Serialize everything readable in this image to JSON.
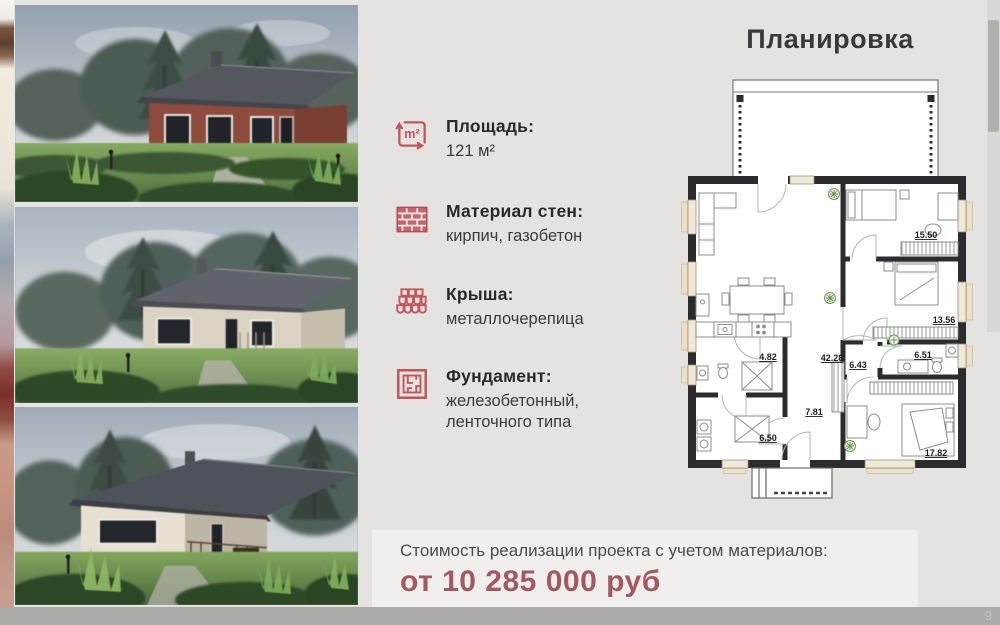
{
  "slide": {
    "plan_title": "Планировка",
    "page_number": "9"
  },
  "specs": {
    "items": [
      {
        "icon": "area-icon",
        "label": "Площадь:",
        "value": "121 м²"
      },
      {
        "icon": "bricks-icon",
        "label": "Материал стен:",
        "value": "кирпич, газобетон"
      },
      {
        "icon": "roof-icon",
        "label": "Крыша:",
        "value": "металлочерепица"
      },
      {
        "icon": "foundation-icon",
        "label": "Фундамент:",
        "value": "железобетонный,\nленточного типа"
      }
    ]
  },
  "price": {
    "label": "Стоимость реализации проекта с учетом материалов:",
    "value": "от 10 285 000 руб"
  },
  "floor_plan": {
    "rooms": {
      "bedroom_top": "15.50",
      "bedroom_mid": "13.56",
      "corridor": "6.43",
      "bathroom_right": "6.51",
      "bathroom_left": "4.82",
      "living_kitchen": "42.28",
      "utility": "6.50",
      "hallway": "7.81",
      "bedroom_master": "17.82"
    }
  },
  "colors": {
    "accent": "#c2575b",
    "price_value": "#a4585f",
    "plan_walls": "#2c2c2e",
    "background": "#e4e3e1"
  }
}
